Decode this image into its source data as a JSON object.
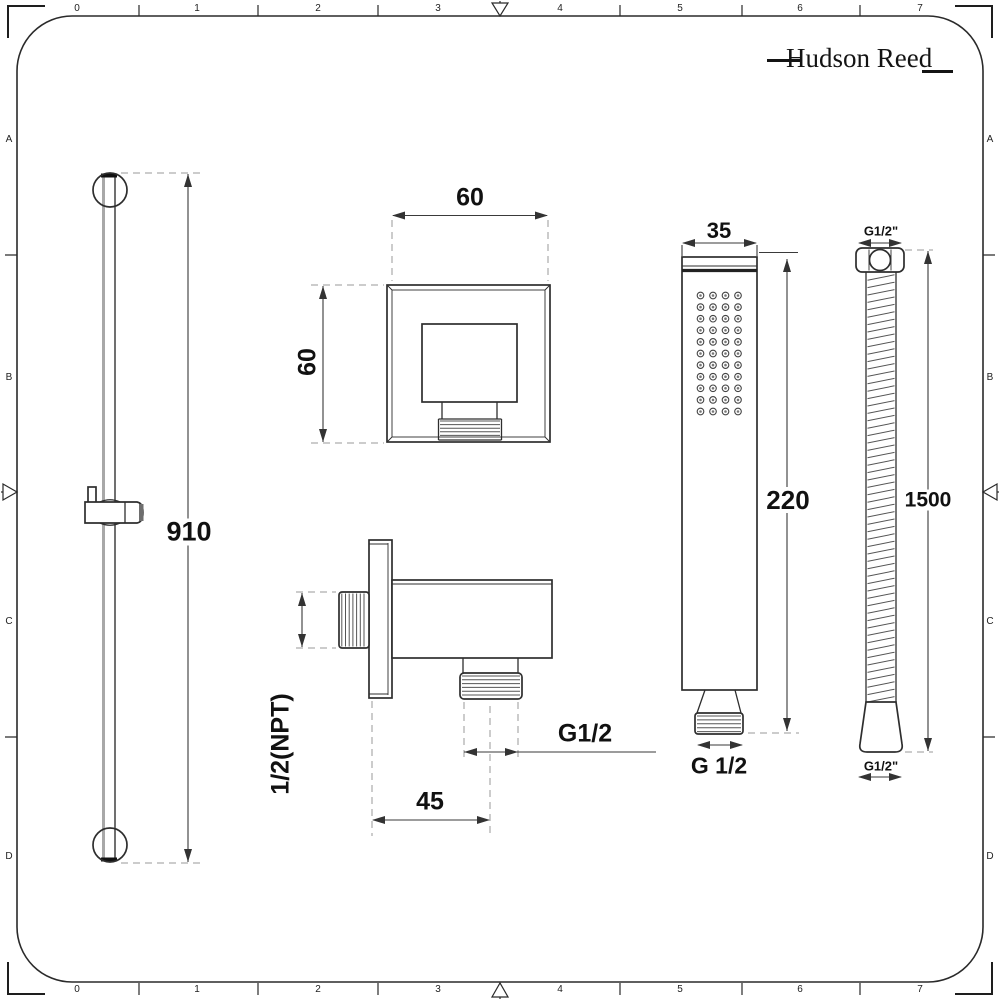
{
  "brand": {
    "name": "Hudson Reed"
  },
  "ruler": {
    "top": [
      "0",
      "1",
      "2",
      "3",
      "4",
      "5",
      "6",
      "7"
    ],
    "bottom": [
      "0",
      "1",
      "2",
      "3",
      "4",
      "5",
      "6",
      "7"
    ],
    "left": [
      "A",
      "B",
      "C",
      "D"
    ],
    "right": [
      "A",
      "B",
      "C",
      "D"
    ]
  },
  "dimensions": {
    "rail_length": "910",
    "outlet_width": "60",
    "outlet_height": "60",
    "outlet_inlet_thread": "1/2(NPT)",
    "outlet_offset": "45",
    "outlet_thread": "G1/2",
    "handset_width": "35",
    "handset_length": "220",
    "handset_thread": "G 1/2",
    "hose_thread_top": "G1/2\"",
    "hose_length": "1500",
    "hose_thread_bottom": "G1/2\""
  }
}
